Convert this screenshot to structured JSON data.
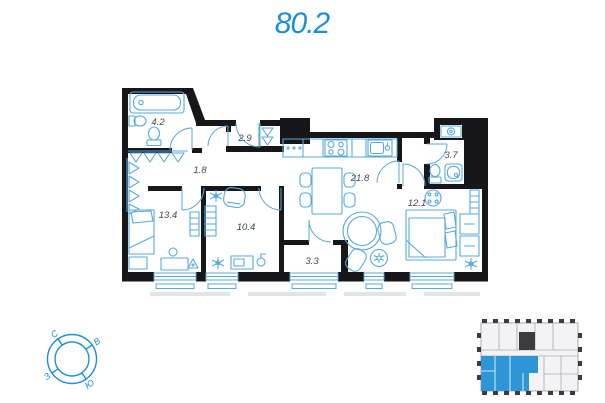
{
  "title": "80.2",
  "colors": {
    "accent": "#1b8ed6",
    "furniture": "#58a9dc",
    "wall": "#17171a",
    "label": "#3f4750",
    "mini_gray": "#ababb0",
    "mini_fill": "#f3f3f5",
    "mini_dark": "#3b3b40",
    "mini_highlight": "#2e96d6",
    "adjacent_gray": "#e4e4e7"
  },
  "plan": {
    "rooms": [
      {
        "name": "bathroom",
        "area": "4.2"
      },
      {
        "name": "wardrobe",
        "area": "2.9"
      },
      {
        "name": "hallway",
        "area": "1.8"
      },
      {
        "name": "bedroom-1",
        "area": "13.4"
      },
      {
        "name": "room",
        "area": "10.4"
      },
      {
        "name": "balcony",
        "area": "3.3"
      },
      {
        "name": "kitchen-living-room",
        "area": "21.8"
      },
      {
        "name": "bathroom-2",
        "area": "3.7"
      },
      {
        "name": "bedroom-2",
        "area": "12.1"
      }
    ]
  },
  "compass": {
    "north": "С",
    "east": "В",
    "west": "З",
    "south": "Ю"
  }
}
